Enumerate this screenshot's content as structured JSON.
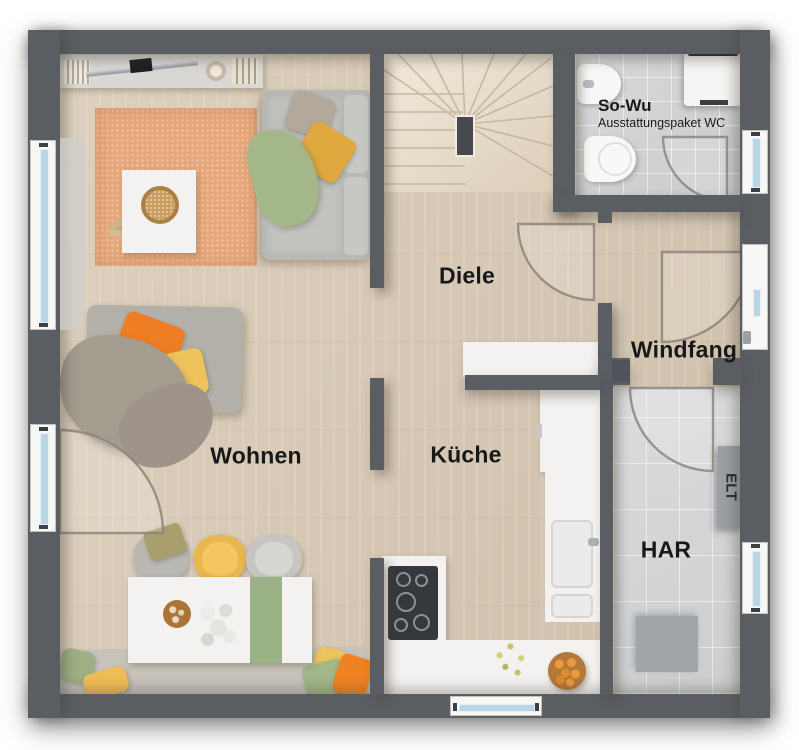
{
  "labels": {
    "wohnen": "Wohnen",
    "diele": "Diele",
    "kueche": "Küche",
    "windfang": "Windfang",
    "har": "HAR",
    "elt": "ELT",
    "wc_title": "So-Wu",
    "wc_subtitle": "Ausstattungspaket WC"
  },
  "colors": {
    "wall": "#5a5e63",
    "wood_floor": "#d7c9b6",
    "tile_floor": "#d3d5d7",
    "stair_wood": "#ece2d1",
    "rug_orange": "#e7a77b",
    "accent_orange": "#ef7d23",
    "accent_yellow": "#eec35c",
    "accent_green": "#a3b789",
    "sofa_gray": "#b7b7b4",
    "window_glass": "#b9d6e6",
    "door_arc": "#8e877c"
  }
}
